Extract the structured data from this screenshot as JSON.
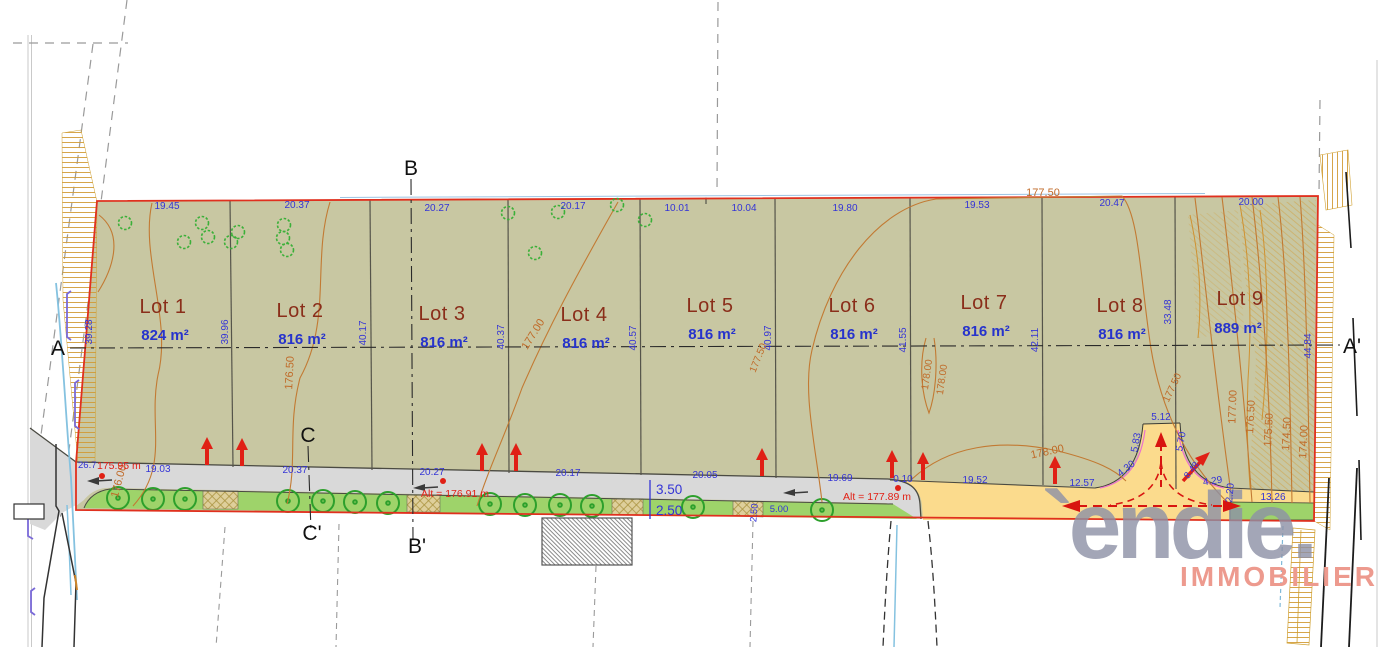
{
  "plan": {
    "lots": [
      {
        "name": "Lot 1",
        "area": "824 m²"
      },
      {
        "name": "Lot 2",
        "area": "816 m²"
      },
      {
        "name": "Lot 3",
        "area": "816 m²"
      },
      {
        "name": "Lot 4",
        "area": "816 m²"
      },
      {
        "name": "Lot 5",
        "area": "816 m²"
      },
      {
        "name": "Lot 6",
        "area": "816 m²"
      },
      {
        "name": "Lot 7",
        "area": "816 m²"
      },
      {
        "name": "Lot 8",
        "area": "816 m²"
      },
      {
        "name": "Lot 9",
        "area": "889 m²"
      }
    ],
    "sections": {
      "a": "A",
      "a_prime": "A'",
      "b": "B",
      "b_prime": "B'",
      "c": "C",
      "c_prime": "C'"
    },
    "dims_top": [
      "19.45",
      "20.37",
      "20.27",
      "20.17",
      "10.01",
      "10.04",
      "19.80",
      "19.53",
      "20.47",
      "20.00"
    ],
    "dims_bottom": [
      "19.03",
      "20.37",
      "20.27",
      "20.17",
      "20.05",
      "19.69",
      "0.10",
      "19.52",
      "12.57"
    ],
    "dims_side": [
      "39.28",
      "39.96",
      "40.17",
      "40.37",
      "40.57",
      "40.97",
      "41.55",
      "42.11",
      "33.48",
      "44.84"
    ],
    "contour_labels": [
      "176.00",
      "176.50",
      "177.00",
      "177.50",
      "177.50",
      "178.00",
      "178.00",
      "178.00",
      "177.50",
      "177.00",
      "176.50",
      "175.50",
      "174.50",
      "174.00"
    ],
    "turnaround": {
      "left_width": "5.83",
      "top_width": "5.12",
      "right_width": "5.70",
      "radius_left": "4.30",
      "radius_right": "4.29",
      "edge": "2.20",
      "green_length": "13.26",
      "access": "8.48"
    },
    "road": {
      "carriageway": "3.50",
      "verge": "2.50",
      "parking_length": "5.00",
      "parking_width": "2.50",
      "left_offset": "26.7"
    },
    "altitudes": {
      "west": "175.95 m",
      "center": "Alt = 176.91 m",
      "east": "Alt = 177.89 m"
    }
  },
  "logo": {
    "brand": "`endie.",
    "tagline": "IMMOBILIER"
  },
  "colors": {
    "parcel_fill": "#c8c7a2",
    "boundary_red": "#e0301e",
    "contour_orange": "#c27a33",
    "dim_blue": "#3434d6",
    "lot_name": "#8a2e1a",
    "road_gray": "#d9d9d9",
    "verge_green": "#9ed36a",
    "future_road_yellow": "#fbdb8d",
    "arrow_red": "#e02015",
    "logo_gray": "#8d91a6",
    "logo_tagline": "#ed9a8e"
  }
}
